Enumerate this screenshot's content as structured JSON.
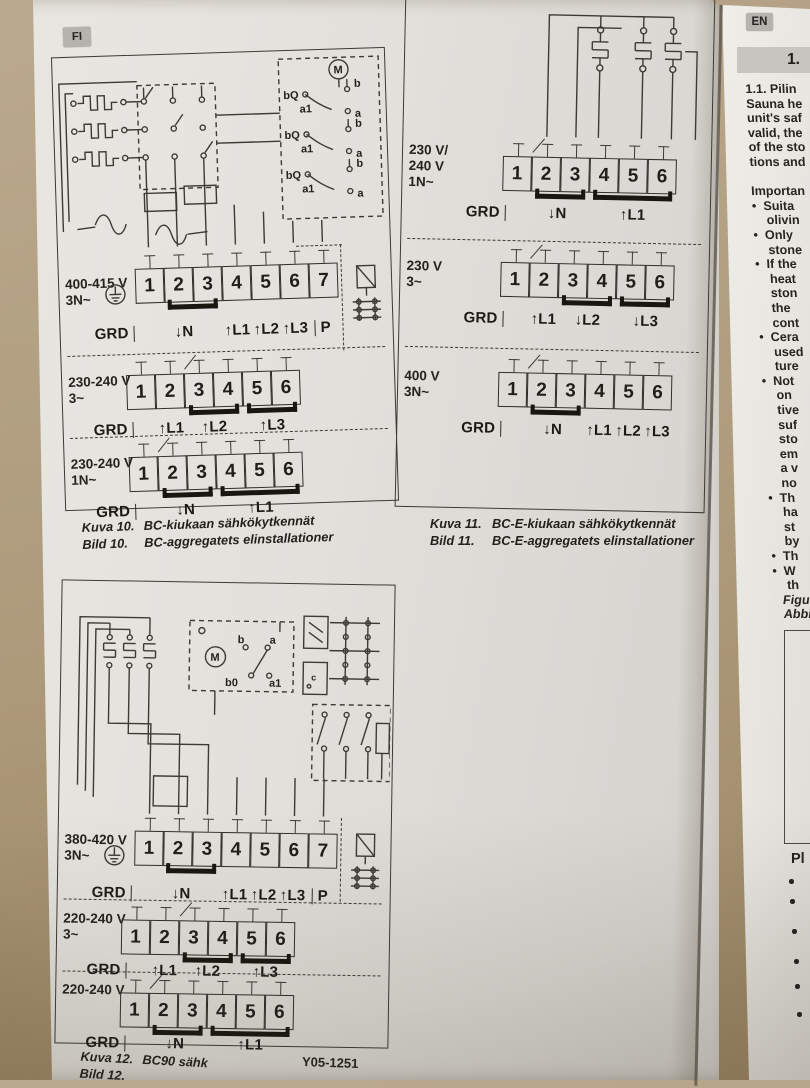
{
  "badges": {
    "fi": "FI",
    "en": "EN"
  },
  "fig10": {
    "schematic": {
      "motor": "M",
      "bq": "bQ",
      "b": "b",
      "a": "a",
      "a1": "a1"
    },
    "rows": [
      {
        "v1": "400-415 V",
        "v2": "3N~",
        "t": [
          "1",
          "2",
          "3",
          "4",
          "5",
          "6",
          "7"
        ],
        "grd": "GRD",
        "n": "↓N",
        "l1": "↑L1",
        "l2": "↑L2",
        "l3": "↑L3",
        "p": "P"
      },
      {
        "v1": "230-240 V",
        "v2": "3~",
        "t": [
          "1",
          "2",
          "3",
          "4",
          "5",
          "6"
        ],
        "grd": "GRD",
        "l1": "↑L1",
        "l2": "↑L2",
        "l3": "↑L3"
      },
      {
        "v1": "230-240 V",
        "v2": "1N~",
        "t": [
          "1",
          "2",
          "3",
          "4",
          "5",
          "6"
        ],
        "grd": "GRD",
        "n": "↓N",
        "l1": "↑L1"
      }
    ],
    "caption": {
      "fi_label": "Kuva 10.",
      "fi_text": "BC-kiukaan sähkökytkennät",
      "sv_label": "Bild 10.",
      "sv_text": "BC-aggregatets elinstallationer"
    }
  },
  "fig11": {
    "blocks": [
      {
        "v1": "230 V/",
        "v2": "240 V",
        "v3": "1N~",
        "t": [
          "1",
          "2",
          "3",
          "4",
          "5",
          "6"
        ],
        "grd": "GRD",
        "n": "↓N",
        "l1": "↑L1"
      },
      {
        "v1": "230 V",
        "v2": "3~",
        "v3": "",
        "t": [
          "1",
          "2",
          "3",
          "4",
          "5",
          "6"
        ],
        "grd": "GRD",
        "l1": "↑L1",
        "l2": "↓L2",
        "l3": "↓L3"
      },
      {
        "v1": "400 V",
        "v2": "3N~",
        "v3": "",
        "t": [
          "1",
          "2",
          "3",
          "4",
          "5",
          "6"
        ],
        "grd": "GRD",
        "n": "↓N",
        "l1": "↑L1",
        "l2": "↑L2",
        "l3": "↑L3"
      }
    ],
    "caption": {
      "fi_label": "Kuva 11.",
      "fi_text": "BC-E-kiukaan sähkökytkennät",
      "sv_label": "Bild 11.",
      "sv_text": "BC-E-aggregatets elinstallationer"
    }
  },
  "fig12": {
    "schematic": {
      "motor": "M",
      "b": "b",
      "a": "a",
      "b0": "b0",
      "a1": "a1",
      "c": "c"
    },
    "rows": [
      {
        "v1": "380-420 V",
        "v2": "3N~",
        "t": [
          "1",
          "2",
          "3",
          "4",
          "5",
          "6",
          "7"
        ],
        "grd": "GRD",
        "n": "↓N",
        "l1": "↑L1",
        "l2": "↑L2",
        "l3": "↑L3",
        "p": "P"
      },
      {
        "v1": "220-240 V",
        "v2": "3~",
        "t": [
          "1",
          "2",
          "3",
          "4",
          "5",
          "6"
        ],
        "grd": "GRD",
        "l1": "↑L1",
        "l2": "↑L2",
        "l3": "↑L3"
      },
      {
        "v1": "220-240 V",
        "v2": "",
        "t": [
          "1",
          "2",
          "3",
          "4",
          "5",
          "6"
        ],
        "grd": "GRD",
        "n": "↓N",
        "l1": "↑L1"
      }
    ],
    "caption": {
      "fi_label": "Kuva 12.",
      "fi_text": "BC90 sähk",
      "sv_label": "Bild 12.",
      "sv_text": ""
    },
    "doc_code": "Y05-1251"
  },
  "en": {
    "section_no": "1.",
    "lines": [
      "1.1. Pilin",
      "Sauna he",
      "unit's saf",
      "valid, the",
      "of the sto",
      "tions and",
      "",
      "Importan",
      "•  Suita",
      "    olivin",
      "•  Only",
      "    stone",
      "•  If the",
      "    heat",
      "    ston",
      "    the",
      "    cont",
      "•  Cera",
      "    used",
      "    ture",
      "•  Not",
      "    on",
      "    tive",
      "    suf",
      "    sto",
      "    em",
      "    a v",
      "    no",
      "•  Th",
      "    ha",
      "    st",
      "    by",
      "•  Th",
      "•  W",
      "    th",
      "Figur",
      "Abbi"
    ],
    "bottom_heading": "Pl"
  }
}
